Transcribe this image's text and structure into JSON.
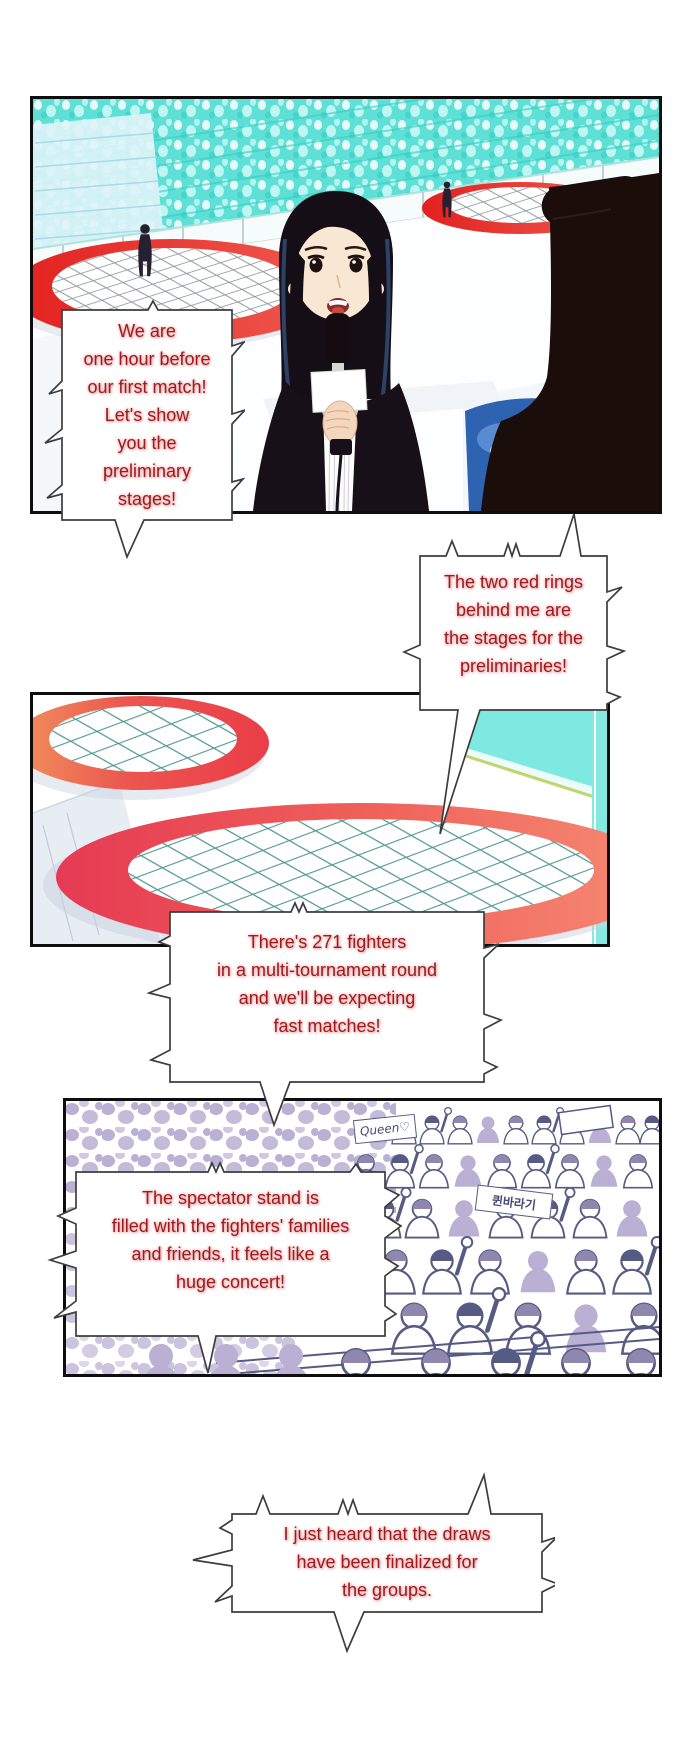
{
  "colors": {
    "dialogue_text": "#9b1b20",
    "dialogue_glow": "#f2bcbc",
    "ring_red": "#e63a54",
    "stands_teal": "#5fe0d6",
    "crowd_lavender": "#b9b0d3",
    "crowd_outline": "#565b84",
    "panel_border": "#0e0e0e"
  },
  "bubbles": [
    {
      "text": "We are\none hour before\nour first match!\nLet's show\nyou the\npreliminary\nstages!"
    },
    {
      "text": "The two red rings\nbehind me are\nthe stages for the\npreliminaries!"
    },
    {
      "text": "There's 271 fighters\nin a multi-tournament round\nand we'll be expecting\nfast matches!"
    },
    {
      "text": "The spectator stand is\nfilled with the fighters' families\nand friends, it feels like a\nhuge concert!"
    },
    {
      "text": "I just heard that the draws\nhave been finalized for\nthe groups."
    }
  ],
  "crowd_signs": [
    {
      "text": "Queen♡"
    },
    {
      "text": "퀸바라기"
    }
  ]
}
